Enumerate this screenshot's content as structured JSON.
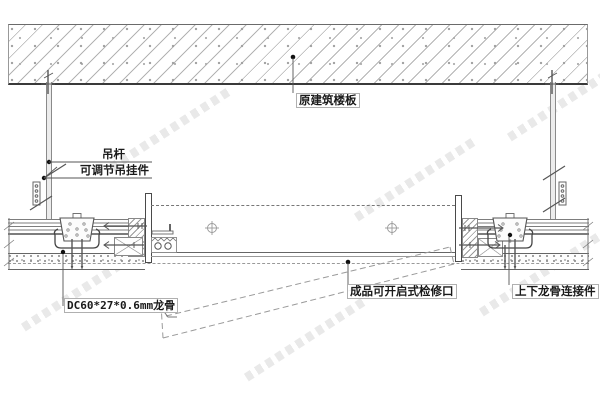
{
  "drawing": {
    "type": "ceiling-access-panel-construction-detail",
    "labels": {
      "slab": "原建筑楼板",
      "hanger_rod": "吊杆",
      "adjustable_hanger": "可调节吊挂件",
      "keel": "DC60*27*0.6mm龙骨",
      "access_panel": "成品可开启式检修口",
      "keel_connector": "上下龙骨连接件"
    },
    "colors": {
      "background": "#ffffff",
      "line_dark": "#444444",
      "line_medium": "#777777",
      "line_light": "#aaaaaa",
      "hatch": "#b3b3b3",
      "text": "#1a1a1a",
      "watermark": "#afafaf"
    }
  }
}
